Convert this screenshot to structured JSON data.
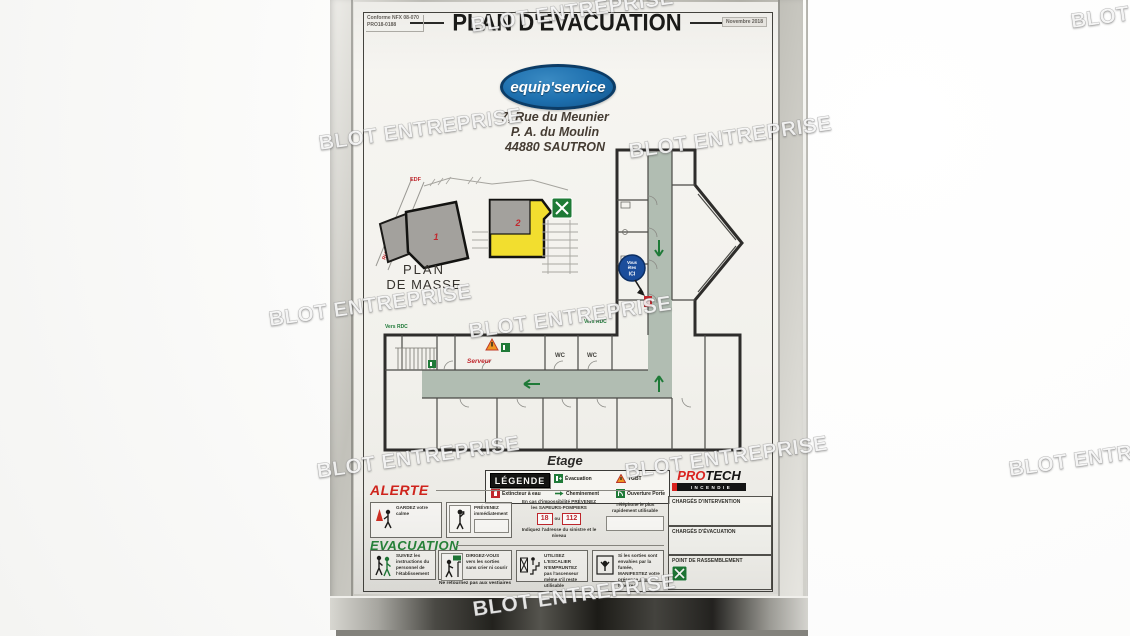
{
  "watermark": {
    "text": "BLOT ENTREPRISE"
  },
  "colors": {
    "logo_blue": "#1d6fae",
    "accent_red": "#c1272d",
    "accent_green": "#1f7a38",
    "corridor_sage": "#b1bdb2",
    "building_gray": "#a3a19d",
    "highlight_yellow": "#f2de2f",
    "frame_silver": "#c2c1ba"
  },
  "poster": {
    "header": {
      "title": "PLAN D'EVACUATION",
      "conformity_line1": "Conforme NFX 08-070",
      "conformity_line2": "PRO18-0188",
      "date": "Novembre 2018"
    },
    "company": {
      "name": "equip'service",
      "address_line1": "7, Rue du Meunier",
      "address_line2": "P. A. du Moulin",
      "address_line3": "44880 SAUTRON"
    },
    "masse": {
      "title_line1": "PLAN",
      "title_line2": "DE MASSE",
      "street": "RUE DU MEUNIER",
      "edf_label": "EDF",
      "building_1": "1",
      "building_2": "2"
    },
    "etage": {
      "title": "Etage",
      "vers_rdc_left": "Vers RDC",
      "vers_rdc_right": "Vers RDC",
      "server_room": "Serveur",
      "wc_left": "WC",
      "wc_right": "WC",
      "you_are_here_line1": "Vous",
      "you_are_here_line2": "êtes",
      "you_are_here_line3": "ICI"
    },
    "legend": {
      "title": "LÉGENDE",
      "items": [
        {
          "icon": "exit-green-icon",
          "label": "Évacuation"
        },
        {
          "icon": "warning-triangle-icon",
          "label": "TGBT"
        },
        {
          "icon": "extinguisher-red-icon",
          "label": "Extincteur à eau"
        },
        {
          "icon": "arrow-green-icon",
          "label": "Cheminement"
        },
        {
          "icon": "door-green-icon",
          "label": "Ouverture Porte"
        }
      ]
    },
    "protech": {
      "pro": "PRO",
      "tech": "TECH",
      "sub": "INCENDIE"
    },
    "alerte": {
      "title": "ALERTE",
      "keep_calm": "GARDEZ votre calme",
      "notify": "PRÉVENEZ immédiatement",
      "firemen_line1": "En cas d'impossibilité PRÉVENEZ",
      "firemen_line2": "les SAPEURS-POMPIERS",
      "number_18": "18",
      "number_or": "ou",
      "number_112": "112",
      "firemen_line3": "Indiquez l'adresse du sinistre et le niveau",
      "phone_note": "Téléphone le plus rapidement utilisable"
    },
    "evacuation": {
      "title": "EVACUATION",
      "step_1": "SUIVEZ les instructions du personnel de l'établissement",
      "step_2": "DIRIGEZ-VOUS vers les sorties sans crier ni courir",
      "step_2b": "Ne retournez pas aux vestiaires",
      "step_3": "UTILISEZ L'ESCALIER N'EMPRUNTEZ pas l'ascenseur même s'il reste utilisable",
      "step_4": "Si les sorties sont envahies par la fumée, MANIFESTEZ votre présence aux fenêtres"
    },
    "responsables": {
      "box_1": "CHARGÉS D'INTERVENTION",
      "box_2": "CHARGÉS D'ÉVACUATION",
      "box_3": "POINT DE RASSEMBLEMENT"
    }
  }
}
